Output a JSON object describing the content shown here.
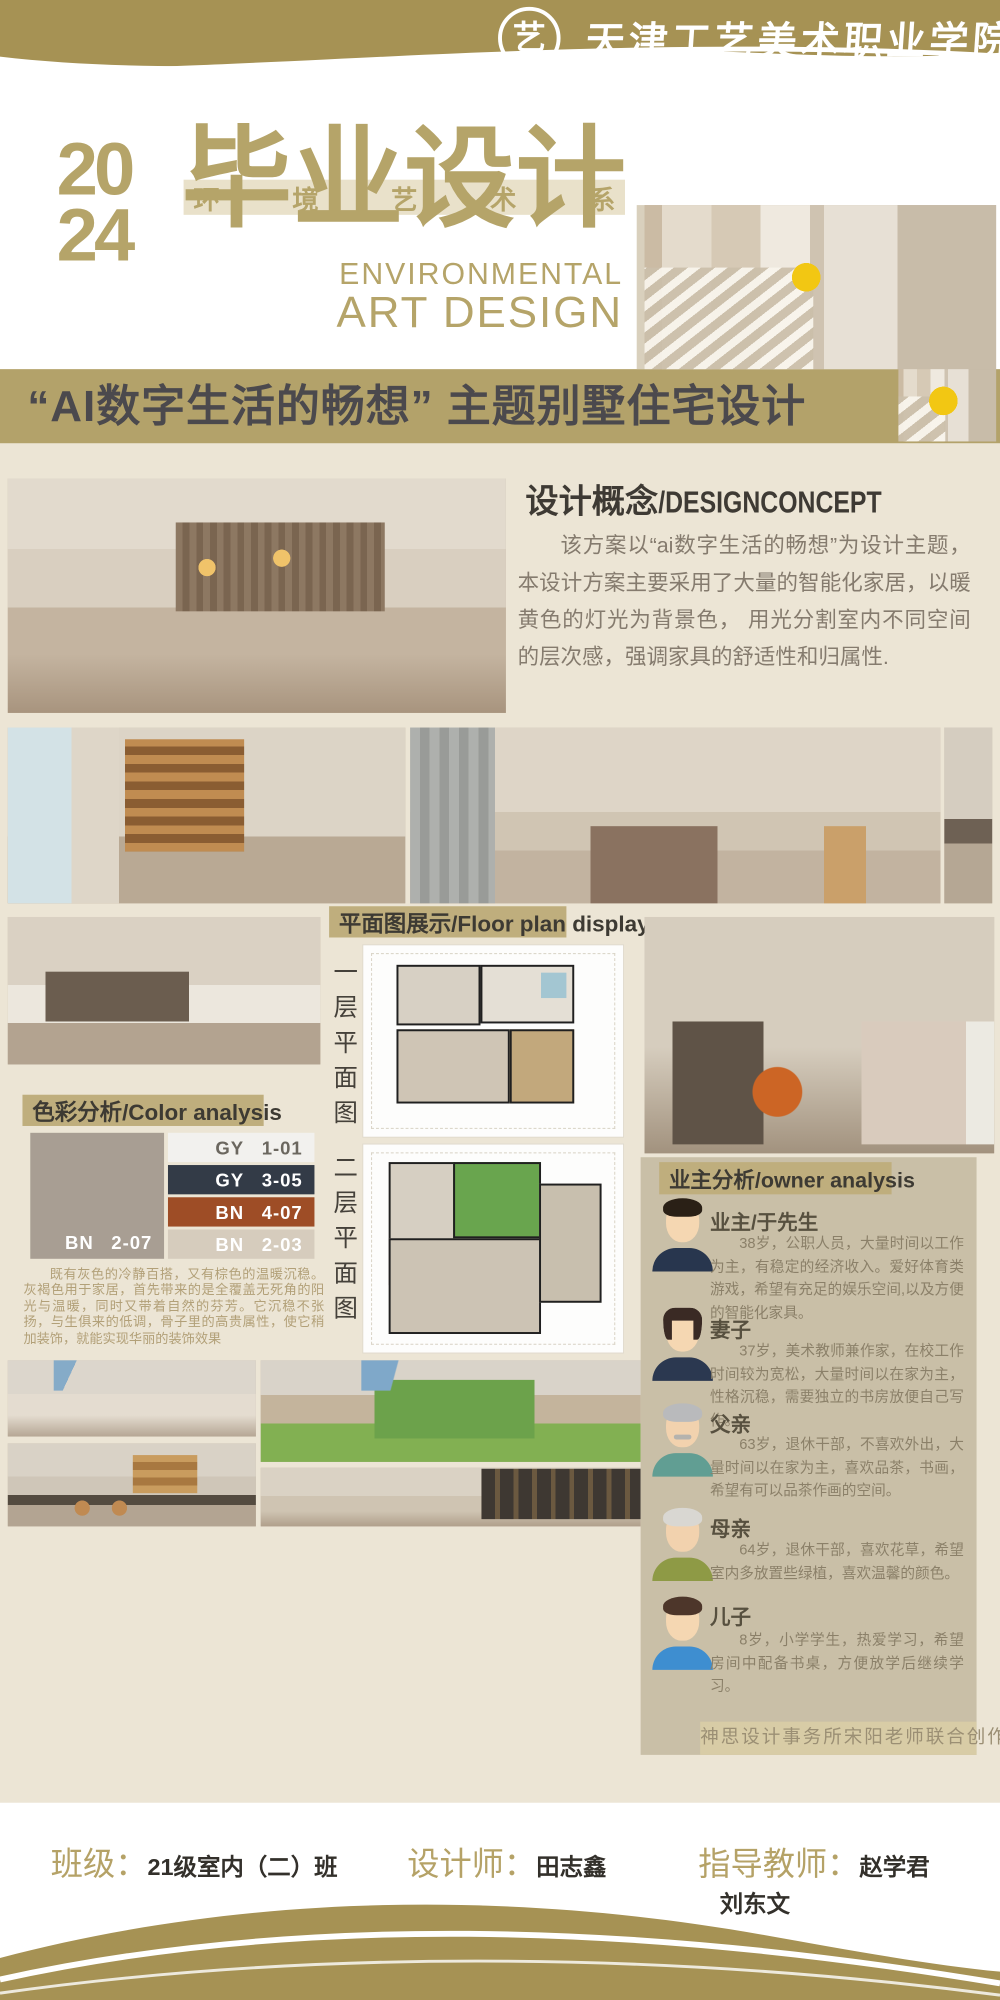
{
  "colors": {
    "banner_gold": "#a69254",
    "title_gold": "#b5a469",
    "theme_band_gold": "#b3a26a",
    "theme_band_text": "#4b494d",
    "page_beige": "#ece5d5",
    "section_band_gold": "#bfae7d",
    "owner_panel": "#c9bfa7",
    "footer_label_gold": "#b5a267"
  },
  "header": {
    "school_name": "天津工艺美术职业学院",
    "logo_glyph": "艺"
  },
  "masthead": {
    "year_top": "20",
    "year_bottom": "24",
    "title": "毕业设计",
    "dept_chars": [
      "环",
      "境",
      "艺",
      "术",
      "系"
    ],
    "subtitle_en_1": "ENVIRONMENTAL",
    "subtitle_en_2": "ART DESIGN"
  },
  "theme_banner": {
    "title": "“AI数字生活的畅想” 主题别墅住宅设计"
  },
  "concept": {
    "heading_zh": "设计概念",
    "heading_en": "/DESIGNCONCEPT",
    "body": "该方案以“ai数字生活的畅想”为设计主题，本设计方案主要采用了大量的智能化家居，以暖黄色的灯光为背景色， 用光分割室内不同空间的层次感，强调家具的舒适性和归属性."
  },
  "floor_plan": {
    "heading": "平面图展示/Floor plan display",
    "label_level1": "一层平面图",
    "label_level2": "二层平面图"
  },
  "color_analysis": {
    "heading": "色彩分析/Color analysis",
    "main_swatch": {
      "label": "BN",
      "code": "2-07",
      "hex": "#a89e93"
    },
    "swatches": [
      {
        "label": "GY",
        "code": "1-01",
        "hex": "#f2f1ee"
      },
      {
        "label": "GY",
        "code": "3-05",
        "hex": "#333b47"
      },
      {
        "label": "BN",
        "code": "4-07",
        "hex": "#9e4d26"
      },
      {
        "label": "BN",
        "code": "2-03",
        "hex": "#d6ccbd"
      }
    ],
    "description": "既有灰色的冷静百搭，又有棕色的温暖沉稳。灰褐色用于家居，首先带来的是全覆盖无死角的阳光与温暖，同时又带着自然的芬芳。它沉稳不张扬，与生俱来的低调，骨子里的高贵属性，使它稍加装饰，就能实现华丽的装饰效果"
  },
  "owner_analysis": {
    "heading": "业主分析/owner analysis",
    "members": [
      {
        "title": "业主/于先生",
        "desc": "38岁，公职人员，大量时间以工作为主，有稳定的经济收入。爱好体育类游戏，希望有充足的娱乐空间,以及方便的智能化家具。"
      },
      {
        "title": "妻子",
        "desc": "37岁，美术教师兼作家，在校工作时间较为宽松，大量时间以在家为主，性格沉稳，需要独立的书房放便自己写作。"
      },
      {
        "title": "父亲",
        "desc": "63岁，退休干部，不喜欢外出，大量时间以在家为主，喜欢品茶，书画，希望有可以品茶作画的空间。"
      },
      {
        "title": "母亲",
        "desc": "64岁，退休干部，喜欢花草，希望室内多放置些绿植，喜欢温馨的颜色。"
      },
      {
        "title": "儿子",
        "desc": "8岁，小学学生，热爱学习，希望房间中配备书桌，方便放学后继续学习。"
      }
    ],
    "credit": "神思设计事务所宋阳老师联合创作"
  },
  "footer": {
    "class_label": "班级：",
    "class_value": "21级室内（二）班",
    "designer_label": "设计师：",
    "designer_value": "田志鑫",
    "advisor_label": "指导教师：",
    "advisor_value_1": "赵学君",
    "advisor_value_2": "刘东文"
  }
}
